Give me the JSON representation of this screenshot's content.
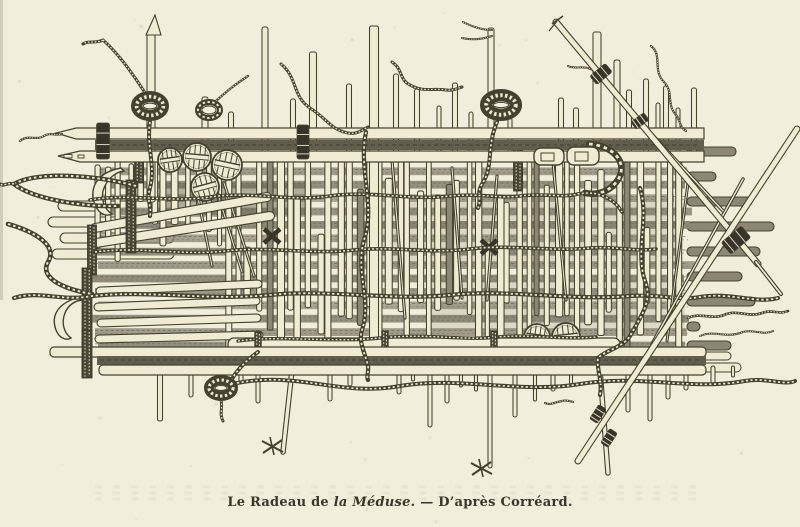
{
  "caption": {
    "prefix": "Le Radeau de ",
    "title": "la Méduse",
    "suffix": ". — D’après Corréard."
  },
  "palette": {
    "paper": "#f3eedb",
    "plank": "#f1ebd3",
    "ink": "#46412f",
    "ink_dark": "#39342a",
    "shade": "#8d8675",
    "shade_dark": "#635d4b",
    "braid": "#4b4535",
    "rope_light": "#ece6cd"
  }
}
